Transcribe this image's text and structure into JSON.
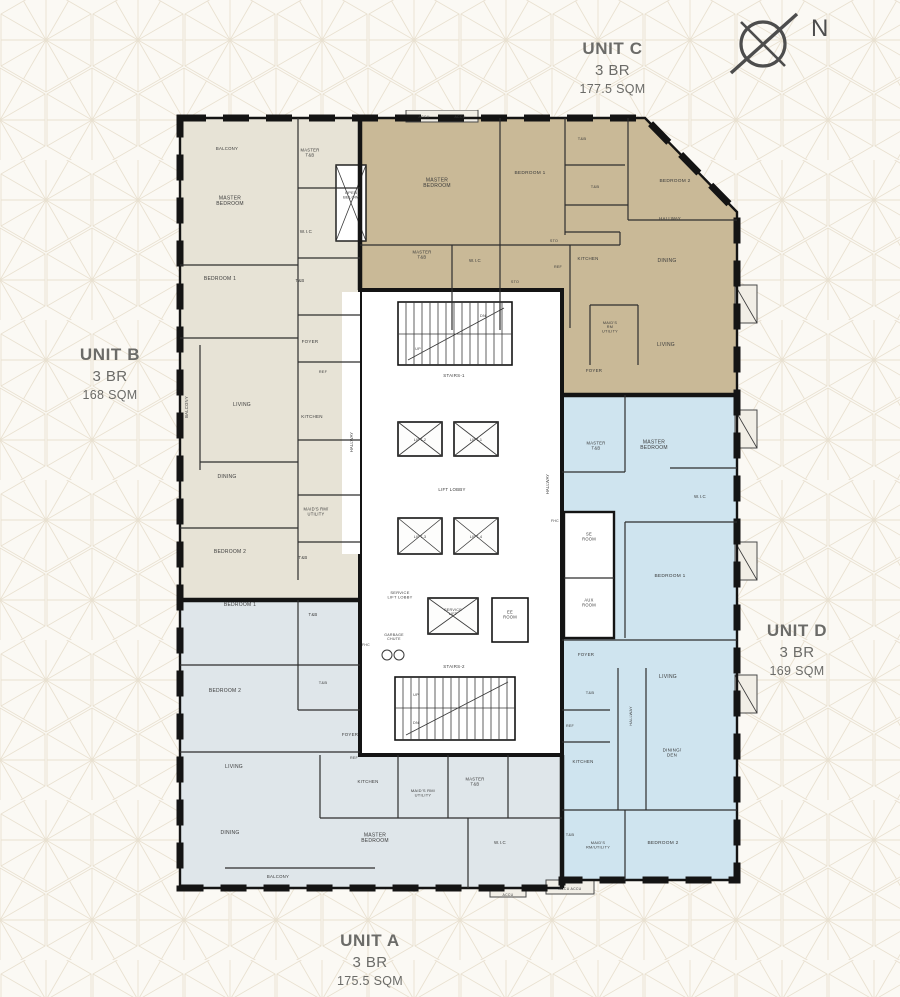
{
  "page": {
    "bg_color": "#fbf9f4",
    "pattern_color": "#e9e1d1"
  },
  "compass": {
    "label": "N"
  },
  "units": {
    "a": {
      "name": "UNIT A",
      "bedrooms": "3 BR",
      "area": "175.5 SQM",
      "color": "#dfe6ea"
    },
    "b": {
      "name": "UNIT B",
      "bedrooms": "3 BR",
      "area": "168 SQM",
      "color": "#e7e3d6"
    },
    "c": {
      "name": "UNIT C",
      "bedrooms": "3 BR",
      "area": "177.5 SQM",
      "color": "#c9b997"
    },
    "d": {
      "name": "UNIT D",
      "bedrooms": "3 BR",
      "area": "169 SQM",
      "color": "#cfe4ef"
    }
  },
  "plan": {
    "wall_color": "#141414",
    "core_fill": "#ffffff",
    "label_color": "#3a3a3a",
    "rooms": [
      {
        "t": "BALCONY",
        "x": 57,
        "y": 40,
        "s": 4.3
      },
      {
        "t": "MASTER\nBEDROOM",
        "x": 60,
        "y": 92,
        "s": 5
      },
      {
        "t": "MASTER\nT&B",
        "x": 140,
        "y": 44,
        "s": 4.2
      },
      {
        "t": "W.I.C",
        "x": 136,
        "y": 123,
        "s": 4.5
      },
      {
        "t": "BEDROOM 1",
        "x": 50,
        "y": 170,
        "s": 5
      },
      {
        "t": "T&B",
        "x": 130,
        "y": 172,
        "s": 4.2
      },
      {
        "t": "FOYER",
        "x": 140,
        "y": 233,
        "s": 4.5
      },
      {
        "t": "REF",
        "x": 153,
        "y": 263,
        "s": 3.8
      },
      {
        "t": "KITCHEN",
        "x": 142,
        "y": 308,
        "s": 4.5
      },
      {
        "t": "BALCONY",
        "x": 18,
        "y": 297,
        "s": 4.2,
        "r": -90
      },
      {
        "t": "LIVING",
        "x": 72,
        "y": 296,
        "s": 5
      },
      {
        "t": "DINING",
        "x": 57,
        "y": 368,
        "s": 5
      },
      {
        "t": "MAID'S RM/\nUTILITY",
        "x": 146,
        "y": 403,
        "s": 4.1
      },
      {
        "t": "BEDROOM 2",
        "x": 60,
        "y": 443,
        "s": 5
      },
      {
        "t": "T&B",
        "x": 133,
        "y": 449,
        "s": 4.2
      },
      {
        "t": "OPEN\nBELOW",
        "x": 181,
        "y": 86,
        "s": 4
      },
      {
        "t": "ACCU",
        "x": 254,
        "y": 8,
        "s": 3.6
      },
      {
        "t": "ACCU",
        "x": 290,
        "y": 8,
        "s": 3.6
      },
      {
        "t": "MASTER\nBEDROOM",
        "x": 267,
        "y": 74,
        "s": 5
      },
      {
        "t": "BEDROOM 1",
        "x": 360,
        "y": 64,
        "s": 4.8
      },
      {
        "t": "T&B",
        "x": 412,
        "y": 30,
        "s": 4
      },
      {
        "t": "T&B",
        "x": 425,
        "y": 78,
        "s": 4
      },
      {
        "t": "HALLWAY",
        "x": 500,
        "y": 110,
        "s": 4.4
      },
      {
        "t": "MASTER\nT&B",
        "x": 252,
        "y": 146,
        "s": 4.2
      },
      {
        "t": "W.I.C",
        "x": 305,
        "y": 152,
        "s": 4.4
      },
      {
        "t": "STO",
        "x": 384,
        "y": 132,
        "s": 3.7
      },
      {
        "t": "STO",
        "x": 345,
        "y": 173,
        "s": 3.7
      },
      {
        "t": "REF",
        "x": 388,
        "y": 158,
        "s": 3.7
      },
      {
        "t": "KITCHEN",
        "x": 418,
        "y": 150,
        "s": 4.4
      },
      {
        "t": "BEDROOM 2",
        "x": 505,
        "y": 72,
        "s": 4.8
      },
      {
        "t": "DINING",
        "x": 497,
        "y": 152,
        "s": 5
      },
      {
        "t": "MAID'S\nRM\nUTILITY",
        "x": 440,
        "y": 218,
        "s": 3.8
      },
      {
        "t": "LIVING",
        "x": 496,
        "y": 236,
        "s": 5
      },
      {
        "t": "FOYER",
        "x": 424,
        "y": 262,
        "s": 4.4
      },
      {
        "t": "MASTER\nT&B",
        "x": 426,
        "y": 337,
        "s": 4.2
      },
      {
        "t": "MASTER\nBEDROOM",
        "x": 484,
        "y": 336,
        "s": 5
      },
      {
        "t": "W.I.C",
        "x": 530,
        "y": 388,
        "s": 4.4
      },
      {
        "t": "BEDROOM 1",
        "x": 500,
        "y": 467,
        "s": 4.8
      },
      {
        "t": "FHC",
        "x": 385,
        "y": 412,
        "s": 3.5
      },
      {
        "t": "SE\nROOM",
        "x": 419,
        "y": 428,
        "s": 4.1
      },
      {
        "t": "AUX\nROOM",
        "x": 419,
        "y": 494,
        "s": 4.1
      },
      {
        "t": "FOYER",
        "x": 416,
        "y": 546,
        "s": 4.4
      },
      {
        "t": "LIVING",
        "x": 498,
        "y": 568,
        "s": 5
      },
      {
        "t": "T&B",
        "x": 420,
        "y": 584,
        "s": 4
      },
      {
        "t": "REF",
        "x": 400,
        "y": 617,
        "s": 3.7
      },
      {
        "t": "KITCHEN",
        "x": 413,
        "y": 653,
        "s": 4.4
      },
      {
        "t": "HALLWAY",
        "x": 462,
        "y": 606,
        "s": 3.9,
        "r": -90
      },
      {
        "t": "DINING/\nDEN",
        "x": 502,
        "y": 644,
        "s": 4.5
      },
      {
        "t": "T&B",
        "x": 400,
        "y": 726,
        "s": 4
      },
      {
        "t": "MAID'S\nRM/UTILITY",
        "x": 428,
        "y": 736,
        "s": 3.9
      },
      {
        "t": "BEDROOM 2",
        "x": 493,
        "y": 734,
        "s": 4.8
      },
      {
        "t": "ACCU  ACCU",
        "x": 400,
        "y": 780,
        "s": 3.5
      },
      {
        "t": "BEDROOM 1",
        "x": 70,
        "y": 496,
        "s": 5
      },
      {
        "t": "T&B",
        "x": 143,
        "y": 506,
        "s": 4.2
      },
      {
        "t": "BEDROOM 2",
        "x": 55,
        "y": 582,
        "s": 5
      },
      {
        "t": "T&B",
        "x": 153,
        "y": 574,
        "s": 4
      },
      {
        "t": "FOYER",
        "x": 180,
        "y": 626,
        "s": 4.4
      },
      {
        "t": "REF",
        "x": 184,
        "y": 649,
        "s": 3.7
      },
      {
        "t": "LIVING",
        "x": 64,
        "y": 658,
        "s": 5
      },
      {
        "t": "DINING",
        "x": 60,
        "y": 724,
        "s": 5
      },
      {
        "t": "BALCONY",
        "x": 108,
        "y": 768,
        "s": 4.3
      },
      {
        "t": "KITCHEN",
        "x": 198,
        "y": 673,
        "s": 4.4
      },
      {
        "t": "MAID'S RM/\nUTILITY",
        "x": 253,
        "y": 684,
        "s": 4
      },
      {
        "t": "MASTER\nT&B",
        "x": 305,
        "y": 673,
        "s": 4.2
      },
      {
        "t": "MASTER\nBEDROOM",
        "x": 205,
        "y": 729,
        "s": 5
      },
      {
        "t": "W.I.C",
        "x": 330,
        "y": 734,
        "s": 4.4
      },
      {
        "t": "ACCU",
        "x": 338,
        "y": 786,
        "s": 3.5
      },
      {
        "t": "STAIRS-1",
        "x": 284,
        "y": 267,
        "s": 4.4
      },
      {
        "t": "DN",
        "x": 313,
        "y": 207,
        "s": 3.8
      },
      {
        "t": "UP",
        "x": 248,
        "y": 240,
        "s": 3.8
      },
      {
        "t": "HALLWAY",
        "x": 183,
        "y": 332,
        "s": 4.1,
        "r": -90,
        "ls": 1.6
      },
      {
        "t": "HALLWAY",
        "x": 379,
        "y": 374,
        "s": 4.1,
        "r": -90,
        "ls": 1.6
      },
      {
        "t": "LIFT-2",
        "x": 250,
        "y": 331,
        "s": 3.8
      },
      {
        "t": "LIFT-1",
        "x": 306,
        "y": 331,
        "s": 3.8
      },
      {
        "t": "LIFT LOBBY",
        "x": 282,
        "y": 381,
        "s": 4.4
      },
      {
        "t": "LIFT-3",
        "x": 250,
        "y": 428,
        "s": 3.8
      },
      {
        "t": "LIFT-4",
        "x": 306,
        "y": 428,
        "s": 3.8
      },
      {
        "t": "SERVICE\nLIFT LOBBY",
        "x": 230,
        "y": 486,
        "s": 4
      },
      {
        "t": "SERVICE\nLIFT",
        "x": 283,
        "y": 503,
        "s": 3.7
      },
      {
        "t": "EE\nROOM",
        "x": 340,
        "y": 506,
        "s": 4.1
      },
      {
        "t": "GARBAGE\nCHUTE",
        "x": 224,
        "y": 528,
        "s": 3.6
      },
      {
        "t": "FHC",
        "x": 196,
        "y": 536,
        "s": 3.5
      },
      {
        "t": "STAIRS-2",
        "x": 284,
        "y": 558,
        "s": 4.4
      },
      {
        "t": "UP",
        "x": 246,
        "y": 586,
        "s": 3.8
      },
      {
        "t": "DN",
        "x": 246,
        "y": 614,
        "s": 3.8
      }
    ]
  }
}
